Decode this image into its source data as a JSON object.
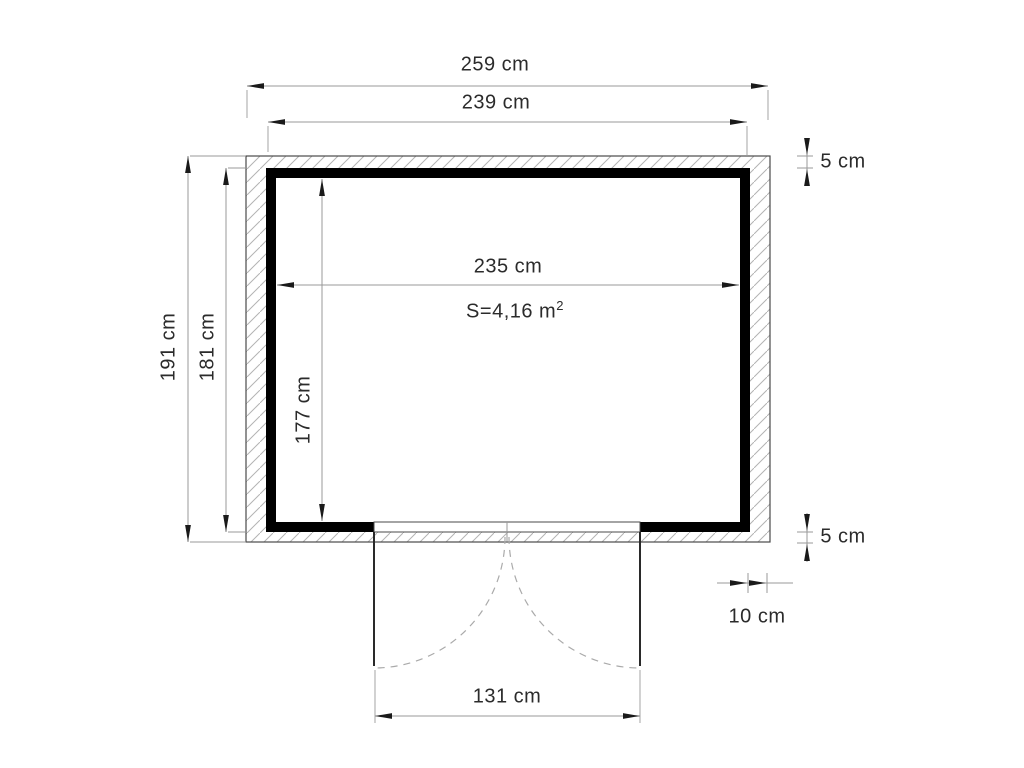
{
  "drawing": {
    "title": "shed-floor-plan",
    "labels": {
      "outer_width": "259 cm",
      "frame_width": "239 cm",
      "interior_width": "235 cm",
      "area_base": "S=4,16 m",
      "area_exp": "2",
      "outer_depth": "191 cm",
      "frame_depth": "181 cm",
      "interior_depth": "177 cm",
      "wall_thickness_top": "5 cm",
      "wall_thickness_bottom": "5 cm",
      "cladding_thickness": "10 cm",
      "door_width": "131 cm"
    },
    "colors": {
      "wall_fill": "#000000",
      "outline": "#4a4a4a",
      "hatch": "#b3b3b3",
      "dimension_line": "#999999",
      "arrow": "#1a1a1a",
      "text": "#2b2b2b"
    }
  }
}
